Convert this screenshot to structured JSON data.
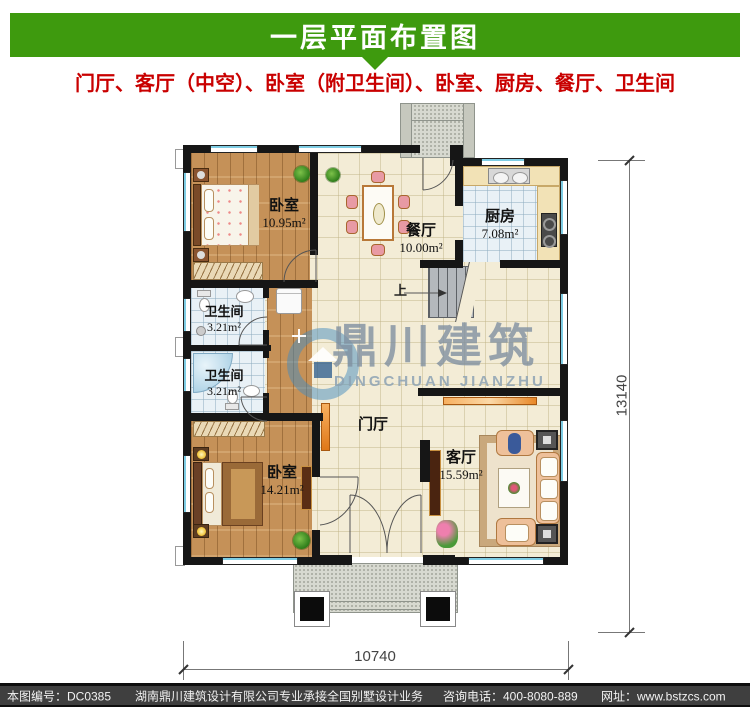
{
  "header": {
    "title": "一层平面布置图"
  },
  "subtitle": "门厅、客厅（中空）、卧室（附卫生间）、卧室、厨房、餐厅、卫生间",
  "rooms": {
    "bedroom1": {
      "name": "卧室",
      "area": "10.95m²"
    },
    "dining": {
      "name": "餐厅",
      "area": "10.00m²"
    },
    "kitchen": {
      "name": "厨房",
      "area": "7.08m²"
    },
    "bath1": {
      "name": "卫生间",
      "area": "3.21m²"
    },
    "bath2": {
      "name": "卫生间",
      "area": "3.21m²"
    },
    "bedroom2": {
      "name": "卧室",
      "area": "14.21m²"
    },
    "foyer": {
      "name": "门厅"
    },
    "living": {
      "name": "客厅",
      "area": "15.59m²"
    }
  },
  "stairs": {
    "up_label": "上"
  },
  "watermark": {
    "cn": "鼎川建筑",
    "en": "DINGCHUAN JIANZHU"
  },
  "dims": {
    "height": "13140",
    "width": "10740"
  },
  "footer": {
    "drawing_no": "本图编号：DC0385",
    "company": "湖南鼎川建筑设计有限公司专业承接全国别墅设计业务",
    "phone": "咨询电话：400-8080-889",
    "website": "网址：www.bstzcs.com"
  },
  "colors": {
    "header_green": "#3e9a0e",
    "subtitle_red": "#c90000",
    "wall_black": "#161616",
    "wood_floor": "#c59158",
    "tile_cream": "#f3ecd6",
    "tile_blue": "#e9f1f6",
    "window_blue": "#7ecde4",
    "footer_gray": "#3f3f3f",
    "cabinet_orange": "#f09a4a"
  }
}
